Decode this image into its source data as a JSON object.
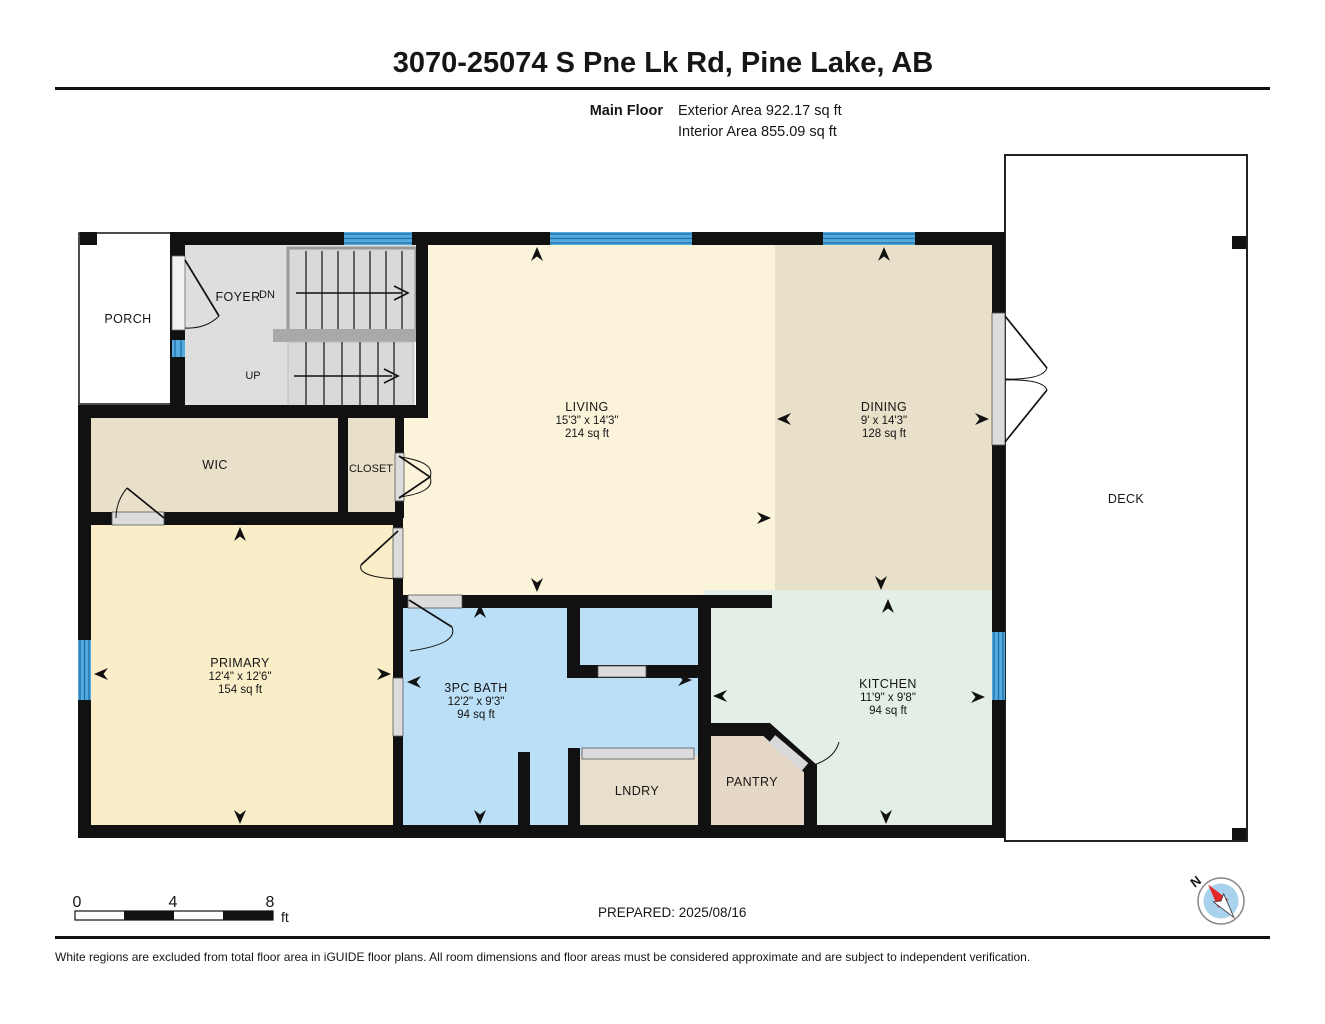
{
  "header": {
    "title": "3070-25074 S Pne Lk Rd, Pine Lake, AB",
    "floor_label": "Main Floor",
    "exterior_area": "Exterior Area 922.17 sq ft",
    "interior_area": "Interior Area 855.09 sq ft"
  },
  "rooms": {
    "porch": {
      "name": "PORCH"
    },
    "foyer": {
      "name": "FOYER",
      "down_label": "DN",
      "up_label": "UP"
    },
    "wic": {
      "name": "WIC"
    },
    "closet": {
      "name": "CLOSET"
    },
    "living": {
      "name": "LIVING",
      "dims": "15'3\" x 14'3\"",
      "area": "214 sq ft"
    },
    "dining": {
      "name": "DINING",
      "dims": "9' x 14'3\"",
      "area": "128 sq ft"
    },
    "deck": {
      "name": "DECK"
    },
    "primary": {
      "name": "PRIMARY",
      "dims": "12'4\" x 12'6\"",
      "area": "154 sq ft"
    },
    "bath": {
      "name": "3PC BATH",
      "dims": "12'2\" x 9'3\"",
      "area": "94 sq ft"
    },
    "kitchen": {
      "name": "KITCHEN",
      "dims": "11'9\" x 9'8\"",
      "area": "94 sq ft"
    },
    "laundry": {
      "name": "LNDRY"
    },
    "pantry": {
      "name": "PANTRY"
    }
  },
  "scale_bar": {
    "tick_0": "0",
    "tick_mid": "4",
    "tick_end": "8",
    "unit": "ft"
  },
  "prepared_label": "PREPARED: 2025/08/16",
  "compass": {
    "north_label": "N"
  },
  "footer": {
    "disclaimer": "White regions are excluded from total floor area in iGUIDE floor plans. All room dimensions and floor areas must be considered approximate and are subject to independent verification."
  },
  "colors": {
    "wall": "#111111",
    "living": "#FBF4DB",
    "dining_tan": "#E9E0CA",
    "primary": "#FAEEC8",
    "bath_blue": "#BBDFF7",
    "kitchen_green": "#E3EFE6",
    "laundry_tan": "#E7DECB",
    "pantry_tan": "#E6D8C6",
    "stairs_gray": "#D9D9D9",
    "window_blue": "#54ABDE",
    "window_line": "#1D6FA6",
    "deck_white": "#FFFFFF",
    "compass_red": "#E32726",
    "compass_blue": "#A8D2EE"
  }
}
